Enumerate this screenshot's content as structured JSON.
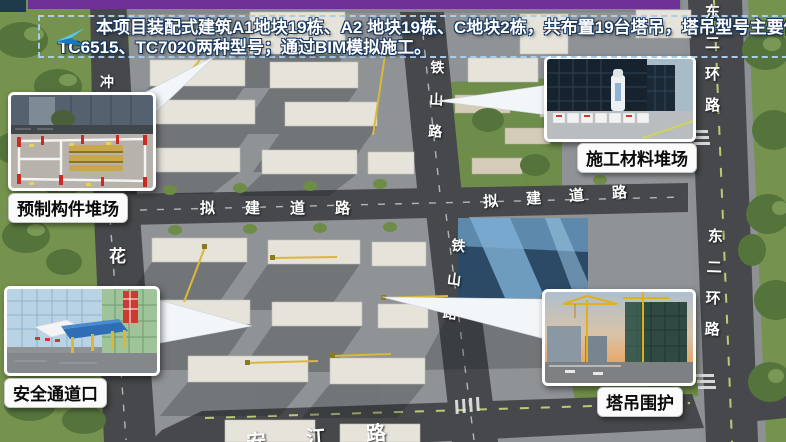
{
  "banner": {
    "line1": "本项目装配式建筑A1地块19栋、A2 地块19栋、C地块2栋，共布置19台塔吊，塔吊型号主要使用",
    "line2": "TC6515、TC7020两种型号；通过BIM模拟施工。",
    "tower_crane_count": "19",
    "crane_models": [
      "TC6515",
      "TC7020"
    ],
    "block_counts": {
      "A1": "19栋",
      "A2": "19栋",
      "C": "2栋"
    }
  },
  "icons": {
    "banner_arrow": "paper-plane-right"
  },
  "callouts": {
    "precast": {
      "label": "预制构件堆场"
    },
    "material": {
      "label": "施工材料堆场"
    },
    "safety": {
      "label": "安全通道口"
    },
    "crane": {
      "label": "塔吊围护"
    }
  },
  "road_labels": {
    "tieshan_upper": "铁山路",
    "tieshan_lower": "铁山路",
    "ring_road_upper": "东二环路",
    "ring_road_lower": "东二环路",
    "planned_road_left": "拟建道路",
    "planned_road_right": "拟建道路",
    "hua_partial": "花",
    "chong_partial": "冲",
    "river_road_partial": "安江路"
  },
  "colors": {
    "accent_bar": "#6e2f96",
    "banner_border": "#a7cdee",
    "banner_text": "#ffffff",
    "banner_text_outline": "#17365d",
    "crane_mark_yellow": "#d9b83a",
    "road_gray": "#46484b",
    "site_gray": "#909396",
    "tree_green": "#5d7c3e",
    "callout_bg": "#fbfbfb"
  }
}
